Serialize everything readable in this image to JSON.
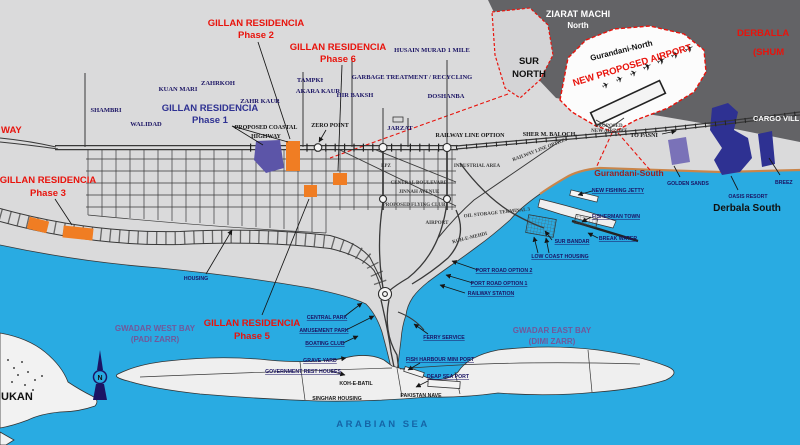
{
  "colors": {
    "sea": "#29ABE2",
    "land": "#DADADB",
    "mountain_band": "#636366",
    "airport_zone_fill": "#FCFCFC",
    "highlight_red": "#E8130C",
    "label_navy": "#1B1464",
    "bay_label_purple": "#71589A",
    "block_orange": "#F07D23",
    "phase1_block_purple": "#5C55A8",
    "resort_navy": "#2E3192",
    "resort_lavender": "#7A72B8",
    "coast_tan": "#C9854A",
    "gurandani_south_red": "#9A2020",
    "arabian_sea_blue": "#1565A7"
  },
  "icons": {
    "plane": "✈"
  },
  "labels": {
    "phase1_name": "GILLAN RESIDENCIA",
    "phase1_sub": "Phase 1",
    "phase2_name": "GILLAN RESIDENCIA",
    "phase2_sub": "Phase 2",
    "phase3_name": "GILLAN RESIDENCIA",
    "phase3_sub": "Phase 3",
    "phase5_name": "GILLAN RESIDENCIA",
    "phase5_sub": "Phase 5",
    "phase6_name": "GILLAN RESIDENCIA",
    "phase6_sub": "Phase 6",
    "ziarat_machi": "ZIARAT MACHI",
    "ziarat_machi_sub": "North",
    "sur_north_1": "SUR",
    "sur_north_2": "NORTH",
    "gurandani_north": "Gurandani-North",
    "new_proposed_airport": "NEW PROPOSED AIRPORT",
    "proposed_1": "PROPOSED",
    "proposed_2": "NEW AIRPORT",
    "to_pasni": "TO PASNI",
    "derballa": "DERBALLA",
    "derballa_sub": "(SHUM",
    "cargo_village": "CARGO VILL",
    "shambri": "SHAMBRI",
    "kuan_mari": "KUAN MARI",
    "zahrkoh": "ZAHRKOH",
    "zahr_kaur": "ZAHR KAUR",
    "walidad": "WALIDAD",
    "tampki": "TAMPKI",
    "akara_kaur": "AKARA KAUR",
    "hir_baksh": "HIR BAKSH",
    "husain_murad": "HUSAIN MURAD 1 MILE",
    "garbage": "GARBAGE TREATMENT / RECYCLING",
    "doshanba": "DOSHANBA",
    "jarzat": "JARZAT",
    "zero_point": "ZERO POINT",
    "coastal_hwy_1": "PROPOSED COASTAL",
    "coastal_hwy_2": "HIGHWAY",
    "hwy_fragment": "WAY",
    "railway_line_option": "RAILWAY LINE OPTION",
    "sher_m_baloch": "SHER M. BALOCH",
    "epz": "EPZ",
    "industrial_area": "INDUSTRIAL AREA",
    "central_boulevard": "CENTRAL BOULEVARD",
    "jinnah_avenue": "JINNAH AVENUE",
    "proposed_flying_club": "PROPOSED FLYING CLUB",
    "airport": "AIRPORT",
    "oil_storage": "OIL STORAGE TERMINAL 3",
    "koh_e_mehdi": "KOH-E-MEHDI",
    "housing": "HOUSING",
    "gurandani_south": "Gurandani-South",
    "golden_sands": "GOLDEN SANDS",
    "oasis_resort": "OASIS RESORT",
    "derbala_south": "Derbala South",
    "breeze": "BREEZ",
    "new_fishing_jetty": "NEW FISHING JETTY",
    "fisherman_town": "FISHERMAN TOWN",
    "break_water": "BREAK WATER",
    "sur_bandar": "SUR BANDAR",
    "low_coast_housing": "LOW COAST HOUSING",
    "port_road_2": "PORT ROAD OPTION 2",
    "port_road_1": "PORT ROAD OPTION 1",
    "railway_station": "RAILWAY STATION",
    "central_park": "CENTRAL PARK",
    "amusement_park": "AMUSEMENT PARK",
    "boating_club": "BOATING CLUB",
    "grave_yard": "GRAVE YARD",
    "govt_rest_houses": "GOVERNMENT REST HOUSES",
    "ferry_service": "FERRY SERVICE",
    "fish_harbour": "FISH HARBOUR MINI PORT",
    "deap_sea_port": "DEAP SEA PORT",
    "koh_e_batil": "KOH-E-BATIL",
    "singhar_housing": "SINGHAR HOUSING",
    "pakistan_nave": "PAKISTAN NAVE",
    "arabian_sea": "ARABIAN SEA",
    "west_bay_1": "GWADAR WEST BAY",
    "west_bay_2": "(PADI ZARR)",
    "east_bay_1": "GWADAR EAST BAY",
    "east_bay_2": "(DIMI ZARR)",
    "pishukan_fragment": "UKAN",
    "compass_n": "N"
  }
}
